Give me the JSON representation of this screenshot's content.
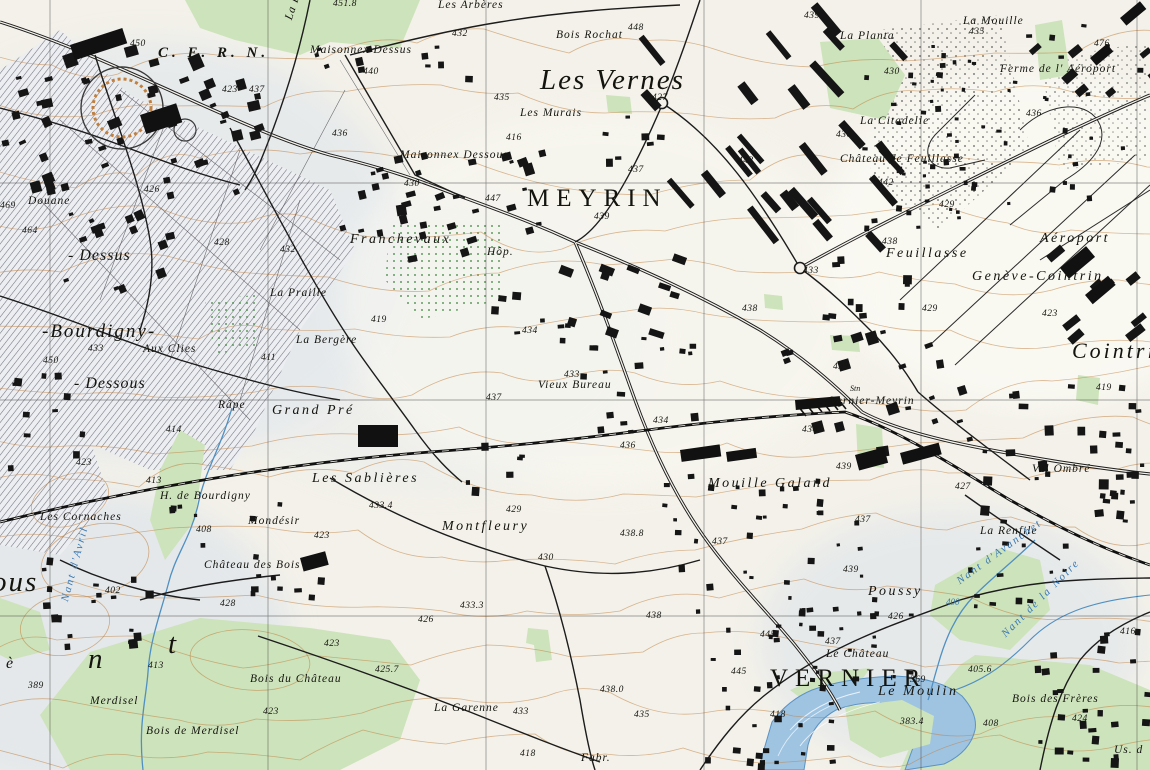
{
  "map": {
    "title": "Topographic map – Meyrin / Vernier / Genève-Cointrin",
    "colors": {
      "paper": "#f3f1e9",
      "ink": "#1a1a1a",
      "contour": "#c08040",
      "forest": "#cde3bb",
      "water_fill": "#a6c6e4",
      "water_line": "#4f8fc2",
      "water_text": "#3878b4",
      "hatch": "#70737d",
      "shade": "#dce4ee",
      "grid": "#3a3a3a"
    },
    "labels": [
      {
        "t": "C. E. R. N.",
        "x": 158,
        "y": 46,
        "c": "cern"
      },
      {
        "t": "Les Vernes",
        "x": 540,
        "y": 66,
        "c": "xl"
      },
      {
        "t": "MEYRIN",
        "x": 527,
        "y": 186,
        "c": "city"
      },
      {
        "t": "VERNIER",
        "x": 770,
        "y": 666,
        "c": "city"
      },
      {
        "t": "Cointrin",
        "x": 1072,
        "y": 340,
        "c": "xl2"
      },
      {
        "t": "-Bourdigny-",
        "x": 42,
        "y": 322,
        "c": "lg"
      },
      {
        "t": "- Dessus",
        "x": 68,
        "y": 248,
        "c": "md2"
      },
      {
        "t": "- Dessous",
        "x": 74,
        "y": 376,
        "c": "md2"
      },
      {
        "t": "ous",
        "x": -8,
        "y": 568,
        "c": "xl"
      },
      {
        "t": "n",
        "x": 88,
        "y": 645,
        "c": "xl"
      },
      {
        "t": "t",
        "x": 168,
        "y": 630,
        "c": "xl"
      },
      {
        "t": "è",
        "x": 6,
        "y": 656,
        "c": "md2"
      },
      {
        "t": "Maisonnex Dessus",
        "x": 310,
        "y": 45,
        "c": "p"
      },
      {
        "t": "Les Arbères",
        "x": 438,
        "y": 0,
        "c": "p"
      },
      {
        "t": "Bois Rochat",
        "x": 556,
        "y": 30,
        "c": "p"
      },
      {
        "t": "La Planta",
        "x": 840,
        "y": 31,
        "c": "p"
      },
      {
        "t": "La Mouille",
        "x": 963,
        "y": 16,
        "c": "p"
      },
      {
        "t": "Ferme de l' Aéroport",
        "x": 1000,
        "y": 64,
        "c": "p"
      },
      {
        "t": "La Citadelle",
        "x": 860,
        "y": 116,
        "c": "p"
      },
      {
        "t": "Château de Feuillasse",
        "x": 840,
        "y": 154,
        "c": "p"
      },
      {
        "t": "Maisonnex Dessous",
        "x": 400,
        "y": 150,
        "c": "p"
      },
      {
        "t": "Franchevaux",
        "x": 350,
        "y": 233,
        "c": "p2"
      },
      {
        "t": "La Praille",
        "x": 270,
        "y": 288,
        "c": "p"
      },
      {
        "t": "Hôp.",
        "x": 487,
        "y": 247,
        "c": "p"
      },
      {
        "t": "Les Murais",
        "x": 520,
        "y": 108,
        "c": "p"
      },
      {
        "t": "Feuillasse",
        "x": 886,
        "y": 247,
        "c": "p2"
      },
      {
        "t": "Aéroport",
        "x": 1040,
        "y": 232,
        "c": "p2"
      },
      {
        "t": "Genève-Cointrin",
        "x": 972,
        "y": 270,
        "c": "p2"
      },
      {
        "t": "Aux Clies",
        "x": 143,
        "y": 344,
        "c": "p"
      },
      {
        "t": "Douane",
        "x": 28,
        "y": 196,
        "c": "p"
      },
      {
        "t": "La Bergère",
        "x": 296,
        "y": 335,
        "c": "p"
      },
      {
        "t": "Vieux Bureau",
        "x": 538,
        "y": 380,
        "c": "p"
      },
      {
        "t": "Grand Pré",
        "x": 272,
        "y": 404,
        "c": "p2"
      },
      {
        "t": "Râpe",
        "x": 218,
        "y": 400,
        "c": "p"
      },
      {
        "t": "H. de Bourdigny",
        "x": 160,
        "y": 491,
        "c": "p"
      },
      {
        "t": "Les Cornaches",
        "x": 40,
        "y": 512,
        "c": "p"
      },
      {
        "t": "Mondésir",
        "x": 248,
        "y": 516,
        "c": "p"
      },
      {
        "t": "Les Sablières",
        "x": 312,
        "y": 472,
        "c": "p2"
      },
      {
        "t": "Montfleury",
        "x": 442,
        "y": 520,
        "c": "p2"
      },
      {
        "t": "Mouille Galand",
        "x": 708,
        "y": 477,
        "c": "p2"
      },
      {
        "t": "Vernier-Meyrin",
        "x": 830,
        "y": 396,
        "c": "p"
      },
      {
        "t": "Stn",
        "x": 850,
        "y": 385,
        "c": "tiny"
      },
      {
        "t": "Val Ombré",
        "x": 1032,
        "y": 464,
        "c": "p"
      },
      {
        "t": "La Renfile",
        "x": 980,
        "y": 526,
        "c": "p"
      },
      {
        "t": "Poussy",
        "x": 868,
        "y": 585,
        "c": "p2"
      },
      {
        "t": "Le Château",
        "x": 826,
        "y": 649,
        "c": "p"
      },
      {
        "t": "Le Moulin",
        "x": 878,
        "y": 685,
        "c": "p2"
      },
      {
        "t": "Bois des Frères",
        "x": 1012,
        "y": 694,
        "c": "p"
      },
      {
        "t": "Bois du Château",
        "x": 250,
        "y": 674,
        "c": "p"
      },
      {
        "t": "Bois de Merdisel",
        "x": 146,
        "y": 726,
        "c": "p"
      },
      {
        "t": "Merdisel",
        "x": 90,
        "y": 696,
        "c": "p"
      },
      {
        "t": "Château des Bois",
        "x": 204,
        "y": 560,
        "c": "p"
      },
      {
        "t": "La Garenne",
        "x": 434,
        "y": 703,
        "c": "p"
      },
      {
        "t": "Fabr.",
        "x": 581,
        "y": 753,
        "c": "p"
      },
      {
        "t": "Us. d",
        "x": 1114,
        "y": 745,
        "c": "p"
      },
      {
        "t": "La Berne",
        "x": 284,
        "y": 18,
        "c": "p",
        "r": -72
      },
      {
        "t": "Nant d'Avril",
        "x": 60,
        "y": 600,
        "c": "w",
        "r": -75
      },
      {
        "t": "Nant d'Avanchet",
        "x": 955,
        "y": 578,
        "c": "w",
        "r": -36
      },
      {
        "t": "Nant de la Noire",
        "x": 1000,
        "y": 632,
        "c": "w",
        "r": -45
      },
      {
        "t": "400",
        "x": 946,
        "y": 598,
        "c": "wh"
      },
      {
        "t": "450",
        "x": 130,
        "y": 40,
        "c": "h"
      },
      {
        "t": "423",
        "x": 222,
        "y": 86,
        "c": "h"
      },
      {
        "t": "437",
        "x": 249,
        "y": 86,
        "c": "h"
      },
      {
        "t": "451.8",
        "x": 333,
        "y": 0,
        "c": "h"
      },
      {
        "t": "440",
        "x": 363,
        "y": 68,
        "c": "h"
      },
      {
        "t": "432",
        "x": 452,
        "y": 30,
        "c": "h"
      },
      {
        "t": "436",
        "x": 332,
        "y": 130,
        "c": "h"
      },
      {
        "t": "435",
        "x": 494,
        "y": 94,
        "c": "h"
      },
      {
        "t": "416",
        "x": 506,
        "y": 134,
        "c": "h"
      },
      {
        "t": "448",
        "x": 628,
        "y": 24,
        "c": "h"
      },
      {
        "t": "439",
        "x": 804,
        "y": 12,
        "c": "h"
      },
      {
        "t": "476",
        "x": 1094,
        "y": 40,
        "c": "h"
      },
      {
        "t": "435",
        "x": 969,
        "y": 28,
        "c": "h"
      },
      {
        "t": "430",
        "x": 884,
        "y": 68,
        "c": "h"
      },
      {
        "t": "436",
        "x": 1026,
        "y": 110,
        "c": "h"
      },
      {
        "t": "427",
        "x": 652,
        "y": 94,
        "c": "h"
      },
      {
        "t": "443",
        "x": 738,
        "y": 157,
        "c": "h"
      },
      {
        "t": "437",
        "x": 628,
        "y": 166,
        "c": "h"
      },
      {
        "t": "439",
        "x": 594,
        "y": 213,
        "c": "h"
      },
      {
        "t": "433",
        "x": 803,
        "y": 267,
        "c": "h"
      },
      {
        "t": "436",
        "x": 836,
        "y": 131,
        "c": "h"
      },
      {
        "t": "442",
        "x": 878,
        "y": 179,
        "c": "h"
      },
      {
        "t": "429",
        "x": 939,
        "y": 201,
        "c": "h"
      },
      {
        "t": "438",
        "x": 882,
        "y": 238,
        "c": "h"
      },
      {
        "t": "429",
        "x": 922,
        "y": 305,
        "c": "h"
      },
      {
        "t": "423",
        "x": 1042,
        "y": 310,
        "c": "h"
      },
      {
        "t": "419",
        "x": 1096,
        "y": 384,
        "c": "h"
      },
      {
        "t": "426",
        "x": 144,
        "y": 186,
        "c": "h"
      },
      {
        "t": "469",
        "x": 0,
        "y": 202,
        "c": "h"
      },
      {
        "t": "464",
        "x": 22,
        "y": 227,
        "c": "h"
      },
      {
        "t": "428",
        "x": 214,
        "y": 239,
        "c": "h"
      },
      {
        "t": "432",
        "x": 280,
        "y": 246,
        "c": "h"
      },
      {
        "t": "447",
        "x": 485,
        "y": 195,
        "c": "h"
      },
      {
        "t": "430",
        "x": 404,
        "y": 180,
        "c": "h"
      },
      {
        "t": "433",
        "x": 88,
        "y": 345,
        "c": "h"
      },
      {
        "t": "450",
        "x": 43,
        "y": 357,
        "c": "h"
      },
      {
        "t": "411",
        "x": 261,
        "y": 354,
        "c": "h"
      },
      {
        "t": "414",
        "x": 166,
        "y": 426,
        "c": "h"
      },
      {
        "t": "419",
        "x": 371,
        "y": 316,
        "c": "h"
      },
      {
        "t": "434",
        "x": 522,
        "y": 327,
        "c": "h"
      },
      {
        "t": "433",
        "x": 564,
        "y": 371,
        "c": "h"
      },
      {
        "t": "437",
        "x": 486,
        "y": 394,
        "c": "h"
      },
      {
        "t": "413",
        "x": 146,
        "y": 477,
        "c": "h"
      },
      {
        "t": "423",
        "x": 76,
        "y": 459,
        "c": "h"
      },
      {
        "t": "408",
        "x": 196,
        "y": 526,
        "c": "h"
      },
      {
        "t": "433.4",
        "x": 369,
        "y": 502,
        "c": "h"
      },
      {
        "t": "423",
        "x": 314,
        "y": 532,
        "c": "h"
      },
      {
        "t": "429",
        "x": 506,
        "y": 506,
        "c": "h"
      },
      {
        "t": "438.8",
        "x": 620,
        "y": 530,
        "c": "h"
      },
      {
        "t": "430",
        "x": 538,
        "y": 554,
        "c": "h"
      },
      {
        "t": "433.3",
        "x": 460,
        "y": 602,
        "c": "h"
      },
      {
        "t": "426",
        "x": 418,
        "y": 616,
        "c": "h"
      },
      {
        "t": "438",
        "x": 646,
        "y": 612,
        "c": "h"
      },
      {
        "t": "438.0",
        "x": 600,
        "y": 686,
        "c": "h"
      },
      {
        "t": "435",
        "x": 634,
        "y": 711,
        "c": "h"
      },
      {
        "t": "418",
        "x": 520,
        "y": 750,
        "c": "h"
      },
      {
        "t": "445",
        "x": 731,
        "y": 668,
        "c": "h"
      },
      {
        "t": "433",
        "x": 513,
        "y": 708,
        "c": "h"
      },
      {
        "t": "425.7",
        "x": 375,
        "y": 666,
        "c": "h"
      },
      {
        "t": "423",
        "x": 324,
        "y": 640,
        "c": "h"
      },
      {
        "t": "428",
        "x": 220,
        "y": 600,
        "c": "h"
      },
      {
        "t": "413",
        "x": 148,
        "y": 662,
        "c": "h"
      },
      {
        "t": "389",
        "x": 28,
        "y": 682,
        "c": "h"
      },
      {
        "t": "402",
        "x": 105,
        "y": 587,
        "c": "h"
      },
      {
        "t": "423",
        "x": 263,
        "y": 708,
        "c": "h"
      },
      {
        "t": "434",
        "x": 653,
        "y": 417,
        "c": "h"
      },
      {
        "t": "436",
        "x": 620,
        "y": 442,
        "c": "h"
      },
      {
        "t": "438",
        "x": 742,
        "y": 305,
        "c": "h"
      },
      {
        "t": "437",
        "x": 712,
        "y": 538,
        "c": "h"
      },
      {
        "t": "437",
        "x": 855,
        "y": 516,
        "c": "h"
      },
      {
        "t": "439",
        "x": 836,
        "y": 463,
        "c": "h"
      },
      {
        "t": "427",
        "x": 955,
        "y": 483,
        "c": "h"
      },
      {
        "t": "439",
        "x": 843,
        "y": 566,
        "c": "h"
      },
      {
        "t": "426",
        "x": 888,
        "y": 613,
        "c": "h"
      },
      {
        "t": "433",
        "x": 833,
        "y": 363,
        "c": "h"
      },
      {
        "t": "434",
        "x": 802,
        "y": 426,
        "c": "h"
      },
      {
        "t": "445",
        "x": 760,
        "y": 631,
        "c": "h"
      },
      {
        "t": "437",
        "x": 825,
        "y": 638,
        "c": "h"
      },
      {
        "t": "369",
        "x": 910,
        "y": 676,
        "c": "h"
      },
      {
        "t": "405.6",
        "x": 968,
        "y": 666,
        "c": "h"
      },
      {
        "t": "383.4",
        "x": 900,
        "y": 718,
        "c": "h"
      },
      {
        "t": "408",
        "x": 983,
        "y": 720,
        "c": "h"
      },
      {
        "t": "424",
        "x": 1072,
        "y": 715,
        "c": "h"
      },
      {
        "t": "418",
        "x": 770,
        "y": 711,
        "c": "h"
      },
      {
        "t": "416",
        "x": 1120,
        "y": 628,
        "c": "h"
      }
    ]
  }
}
